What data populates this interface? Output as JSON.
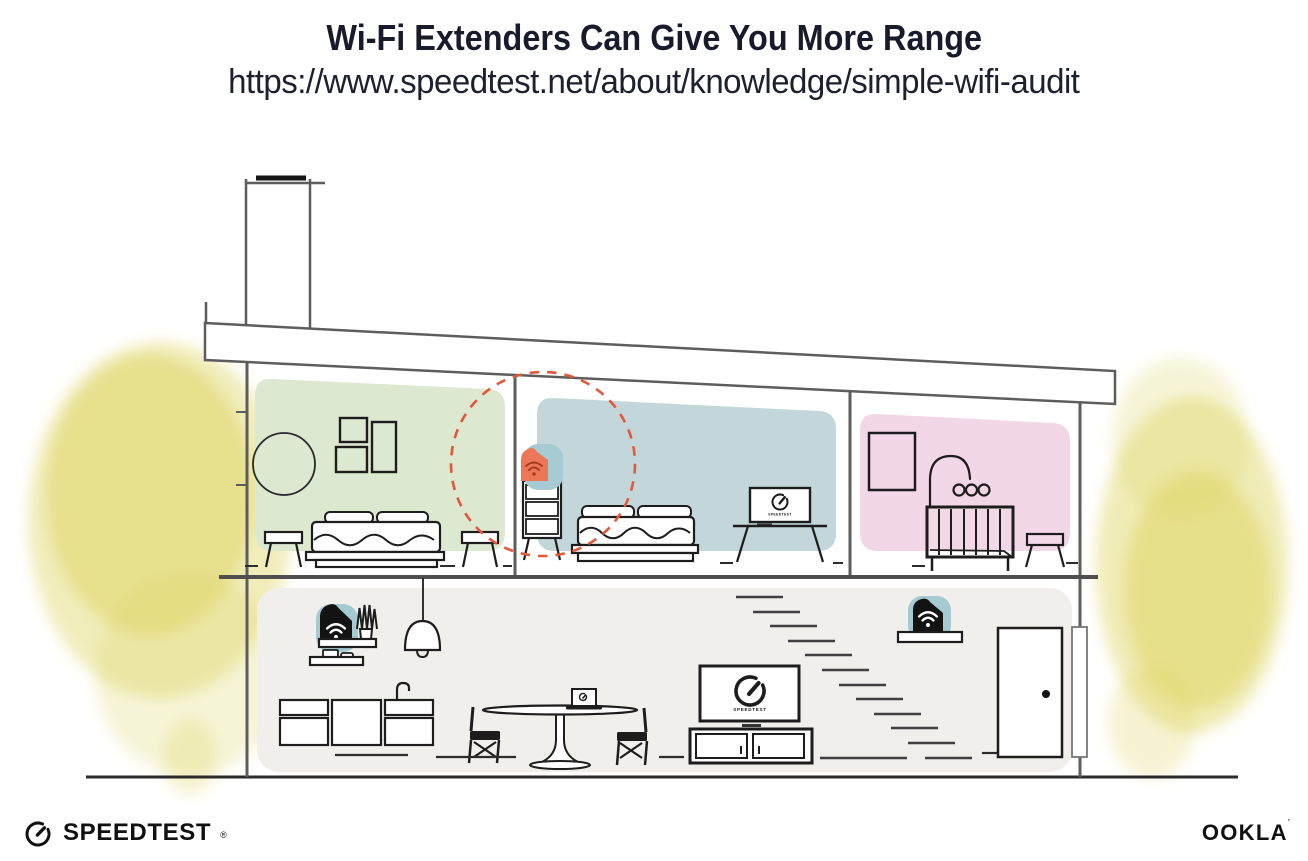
{
  "header": {
    "title": "Wi-Fi Extenders Can Give You More Range",
    "url": "https://www.speedtest.net/about/knowledge/simple-wifi-audit"
  },
  "footer": {
    "speedtest_wordmark": "SPEEDTEST",
    "speedtest_reg_mark": "®",
    "ookla_wordmark": "OOKLA",
    "ookla_mark": "’"
  },
  "illustration": {
    "living_tv_label": "SPEEDTEST",
    "bedroom_tv_label": "SPEEDTEST"
  },
  "colors": {
    "ink": "#181b2b",
    "line-gray": "#5d5d5d",
    "furniture": "#1d1d1d",
    "room-green": "#dde8d0",
    "room-blue": "#c3d7da",
    "room-pink": "#f2d7e6",
    "floor-gray": "#f0efeb",
    "teal-blob": "#a6cad1",
    "extender-orange": "#ec7757",
    "wifi-orange-deep": "#a63d1f",
    "device-black": "#131313",
    "range-dash-red": "#e2593a",
    "foliage-yellow": "#ddd45e"
  }
}
